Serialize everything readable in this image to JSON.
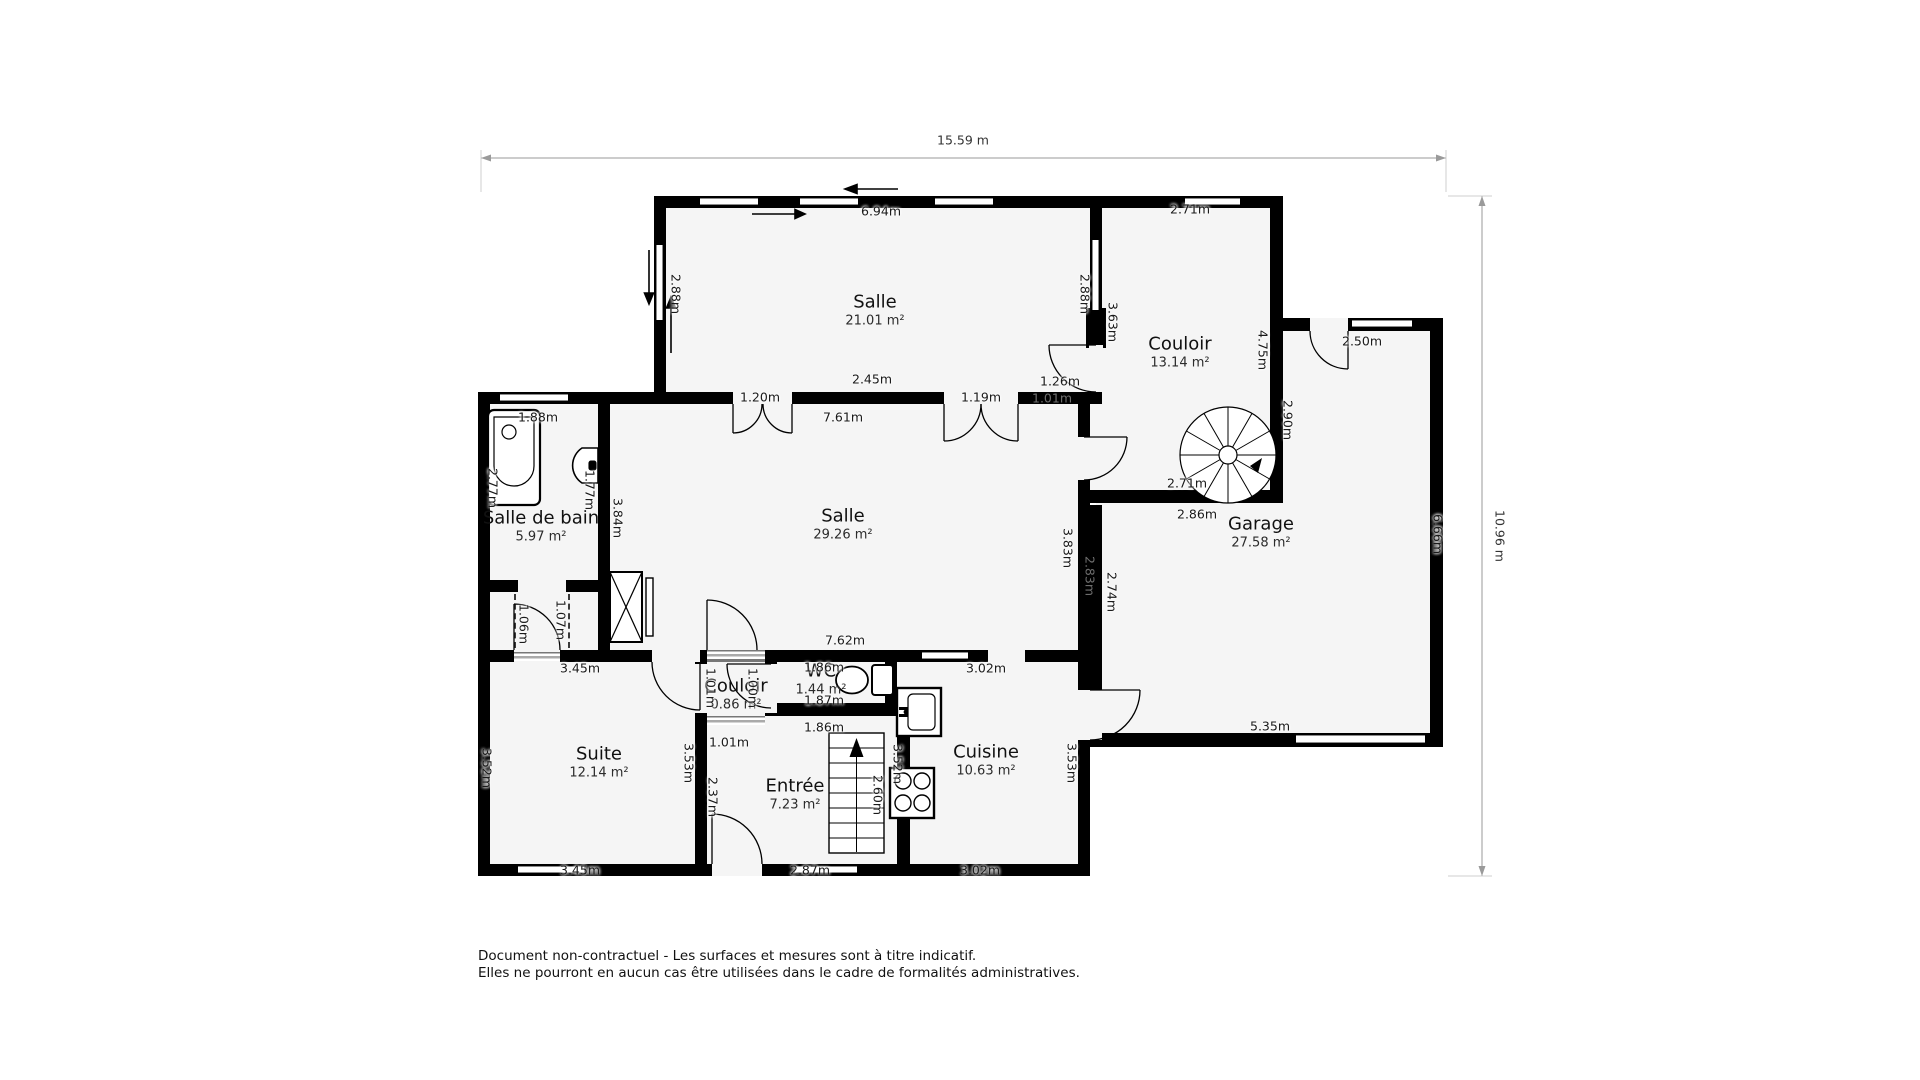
{
  "overall_dimensions": {
    "width": "15.59 m",
    "height": "10.96 m"
  },
  "footer": {
    "line1": "Document non-contractuel - Les surfaces et mesures sont à titre indicatif.",
    "line2": "Elles ne pourront en aucun cas être utilisées dans le cadre de formalités administratives."
  },
  "rooms": [
    {
      "name": "Salle",
      "area": "21.01 m²",
      "x": 875,
      "y": 310
    },
    {
      "name": "Couloir",
      "area": "13.14 m²",
      "x": 1180,
      "y": 352
    },
    {
      "name": "Garage",
      "area": "27.58 m²",
      "x": 1261,
      "y": 532
    },
    {
      "name": "Salle",
      "area": "29.26 m²",
      "x": 843,
      "y": 524
    },
    {
      "name": "Salle de bain",
      "area": "5.97 m²",
      "x": 541,
      "y": 526
    },
    {
      "name": "Suite",
      "area": "12.14 m²",
      "x": 599,
      "y": 762
    },
    {
      "name": "Couloir",
      "area": "0.86 m²",
      "x": 736,
      "y": 694
    },
    {
      "name": "WC",
      "area": "1.44 m²",
      "x": 821,
      "y": 679
    },
    {
      "name": "Entrée",
      "area": "7.23 m²",
      "x": 795,
      "y": 794
    },
    {
      "name": "Cuisine",
      "area": "10.63 m²",
      "x": 986,
      "y": 760
    }
  ],
  "dim_labels": [
    {
      "t": "6.94m",
      "x": 881,
      "y": 211
    },
    {
      "t": "2.88m",
      "x": 676,
      "y": 294,
      "r": 1
    },
    {
      "t": "2.88m",
      "x": 1085,
      "y": 294,
      "r": 1
    },
    {
      "t": "3.63m",
      "x": 1113,
      "y": 322,
      "r": 1
    },
    {
      "t": "2.71m",
      "x": 1190,
      "y": 209
    },
    {
      "t": "4.75m",
      "x": 1263,
      "y": 350,
      "r": 1
    },
    {
      "t": "2.90m",
      "x": 1288,
      "y": 420,
      "r": 1
    },
    {
      "t": "2.50m",
      "x": 1362,
      "y": 341
    },
    {
      "t": "1.26m",
      "x": 1060,
      "y": 381
    },
    {
      "t": "2.45m",
      "x": 872,
      "y": 379
    },
    {
      "t": "1.20m",
      "x": 760,
      "y": 397
    },
    {
      "t": "1.19m",
      "x": 981,
      "y": 397
    },
    {
      "t": "1.01m",
      "x": 1052,
      "y": 398,
      "g": 1
    },
    {
      "t": "7.61m",
      "x": 843,
      "y": 417
    },
    {
      "t": "1.88m",
      "x": 538,
      "y": 417
    },
    {
      "t": "2.77m",
      "x": 493,
      "y": 488,
      "r": 1
    },
    {
      "t": "1.77m",
      "x": 590,
      "y": 490,
      "r": 1
    },
    {
      "t": "3.84m",
      "x": 618,
      "y": 518,
      "r": 1
    },
    {
      "t": "3.83m",
      "x": 1068,
      "y": 548,
      "r": 1
    },
    {
      "t": "2.83m",
      "x": 1090,
      "y": 576,
      "r": 1,
      "g": 1
    },
    {
      "t": "2.74m",
      "x": 1112,
      "y": 592,
      "r": 1
    },
    {
      "t": "6.66m",
      "x": 1438,
      "y": 534,
      "r": 1
    },
    {
      "t": "2.71m",
      "x": 1187,
      "y": 483
    },
    {
      "t": "2.86m",
      "x": 1197,
      "y": 514
    },
    {
      "t": "5.35m",
      "x": 1270,
      "y": 726
    },
    {
      "t": "1.06m",
      "x": 524,
      "y": 624,
      "r": 1
    },
    {
      "t": "1.07m",
      "x": 561,
      "y": 620,
      "r": 1
    },
    {
      "t": "3.45m",
      "x": 580,
      "y": 668
    },
    {
      "t": "7.62m",
      "x": 845,
      "y": 640
    },
    {
      "t": "3.02m",
      "x": 986,
      "y": 668
    },
    {
      "t": "1.86m",
      "x": 824,
      "y": 667
    },
    {
      "t": "1.87m",
      "x": 824,
      "y": 700
    },
    {
      "t": "1.86m",
      "x": 824,
      "y": 727
    },
    {
      "t": "1.01m",
      "x": 711,
      "y": 688,
      "r": 1
    },
    {
      "t": "1.00m",
      "x": 753,
      "y": 688,
      "r": 1
    },
    {
      "t": "1.01m",
      "x": 729,
      "y": 742
    },
    {
      "t": "3.52m",
      "x": 487,
      "y": 768,
      "r": 1
    },
    {
      "t": "3.53m",
      "x": 689,
      "y": 763,
      "r": 1
    },
    {
      "t": "2.37m",
      "x": 713,
      "y": 797,
      "r": 1
    },
    {
      "t": "2.60m",
      "x": 878,
      "y": 795,
      "r": 1
    },
    {
      "t": "3.52m",
      "x": 898,
      "y": 764,
      "r": 1
    },
    {
      "t": "3.53m",
      "x": 1072,
      "y": 763,
      "r": 1
    },
    {
      "t": "3.45m",
      "x": 580,
      "y": 870
    },
    {
      "t": "2.87m",
      "x": 810,
      "y": 870
    },
    {
      "t": "3.02m",
      "x": 980,
      "y": 870
    }
  ],
  "fixtures": [
    "bathtub",
    "bathroom-sink",
    "toilet",
    "kitchen-sink",
    "stove-burners",
    "spiral-staircase",
    "straight-staircase",
    "closet-duct"
  ],
  "colors": {
    "wall": "#000000",
    "floor": "#f5f5f5",
    "label": "#1a1a1a",
    "ghost_label": "#6e6e6e",
    "dim_line": "#9a9a9a"
  }
}
